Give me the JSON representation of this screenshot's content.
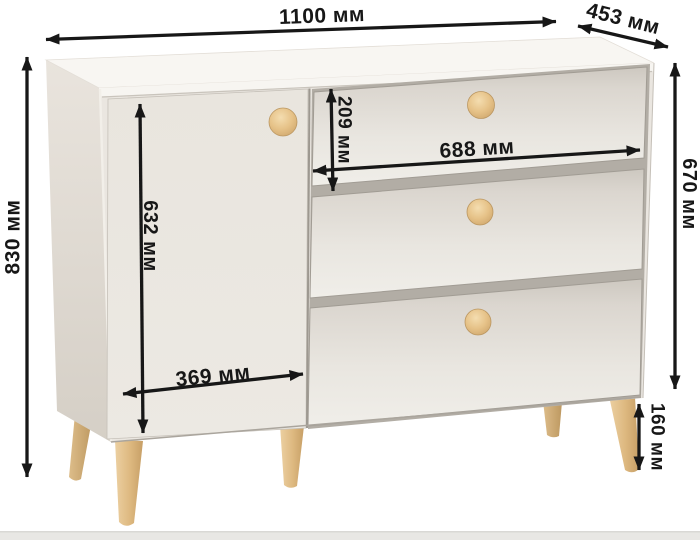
{
  "diagram": {
    "unit_suffix": "мм",
    "dimensions": {
      "overall_width": "1100 мм",
      "depth": "453 мм",
      "overall_height": "830 мм",
      "carcass_height": "670 мм",
      "top_drawer_height": "209 мм",
      "drawer_front_width": "688 мм",
      "door_height": "632 мм",
      "door_width": "369 мм",
      "leg_height": "160 мм"
    },
    "colors": {
      "background": "#ffffff",
      "dimension_lines": "#171717",
      "carcass_front": "#eae6e0",
      "carcass_top": "#f8f6f2",
      "carcass_side": "#dcd6ce",
      "wood_accents": "#ddb87f",
      "floor_strip": "#e8e7e4"
    }
  }
}
